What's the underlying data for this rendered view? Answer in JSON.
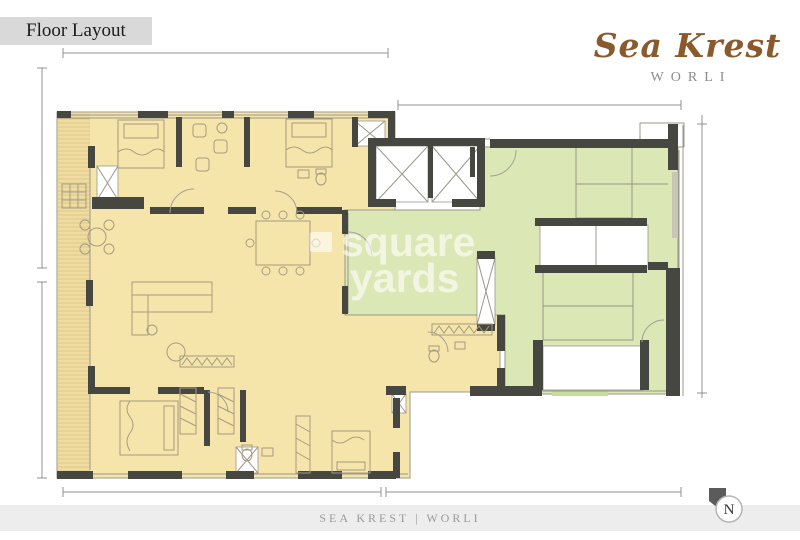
{
  "header": {
    "label": "Floor Layout"
  },
  "brand": {
    "name": "Sea Krest",
    "location": "WORLI"
  },
  "watermark": {
    "line1": "square",
    "line2": "yards"
  },
  "footer": {
    "caption": "SEA KREST | WORLI"
  },
  "compass": {
    "letter": "N"
  },
  "colors": {
    "label_bg": "#d9d9d9",
    "label_text": "#1c1c1c",
    "brand_name": "#8a5a2d",
    "brand_location": "#8c8c8c",
    "footer_bg": "#ededed",
    "footer_text": "#9a9a9a",
    "apartment_fill": "#f6e5ab",
    "balcony_fill": "#efdc9e",
    "balcony_hatch": "#dcc98e",
    "common_fill": "#dbe7b4",
    "doormat_fill": "#c8dd9a",
    "stair_tread": "#97a07c",
    "wall_dark": "#474741",
    "window_strip": "#c9c6b8",
    "furniture_line": "#a59c7e",
    "dim_line": "#909090",
    "compass_dark": "#5b5b5b"
  }
}
